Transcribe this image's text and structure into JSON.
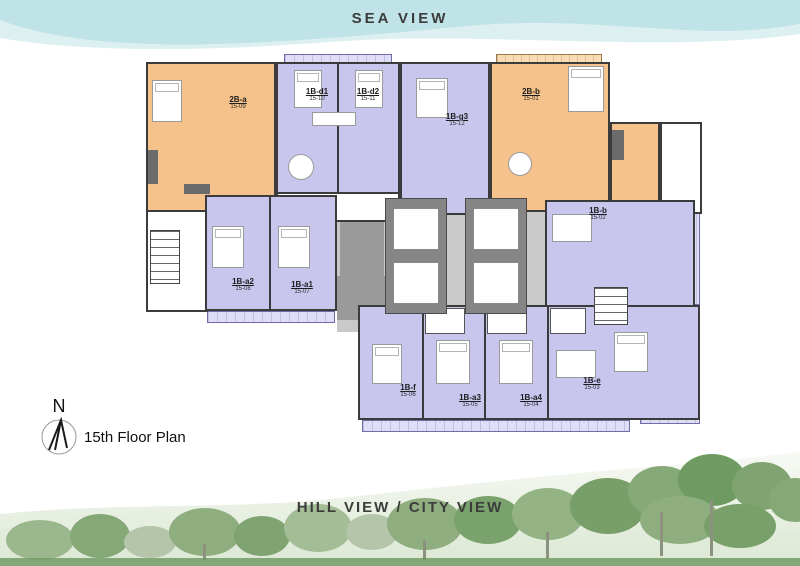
{
  "header": {
    "title": "SEA VIEW"
  },
  "footer": {
    "title": "HILL VIEW / CITY VIEW"
  },
  "legend": {
    "north_letter": "N",
    "floor_label": "15th Floor Plan"
  },
  "plan": {
    "colors": {
      "unit_2bed": "#f5c28b",
      "unit_1bed": "#c9c6ee",
      "balcony": "#dfddf7",
      "corridor": "#c9c9c9",
      "core": "#868686",
      "wall": "#3b3b3b",
      "sea": "#bfe3e6",
      "sea_light": "#ddf0f1",
      "text": "#3c3c3c"
    },
    "units": [
      {
        "code": "2B-a",
        "no": "15-09",
        "type": "2-bedroom"
      },
      {
        "code": "1B-d1",
        "no": "15-10",
        "type": "1-bedroom"
      },
      {
        "code": "1B-d2",
        "no": "15-11",
        "type": "1-bedroom"
      },
      {
        "code": "1B-g3",
        "no": "15-12",
        "type": "1-bedroom"
      },
      {
        "code": "2B-b",
        "no": "15-01",
        "type": "2-bedroom"
      },
      {
        "code": "1B-b",
        "no": "15-02",
        "type": "1-bedroom"
      },
      {
        "code": "1B-a2",
        "no": "15-08",
        "type": "1-bedroom"
      },
      {
        "code": "1B-a1",
        "no": "15-07",
        "type": "1-bedroom"
      },
      {
        "code": "1B-f",
        "no": "15-06",
        "type": "1-bedroom"
      },
      {
        "code": "1B-a3",
        "no": "15-05",
        "type": "1-bedroom"
      },
      {
        "code": "1B-a4",
        "no": "15-04",
        "type": "1-bedroom"
      },
      {
        "code": "1B-e",
        "no": "15-03",
        "type": "1-bedroom"
      }
    ]
  }
}
